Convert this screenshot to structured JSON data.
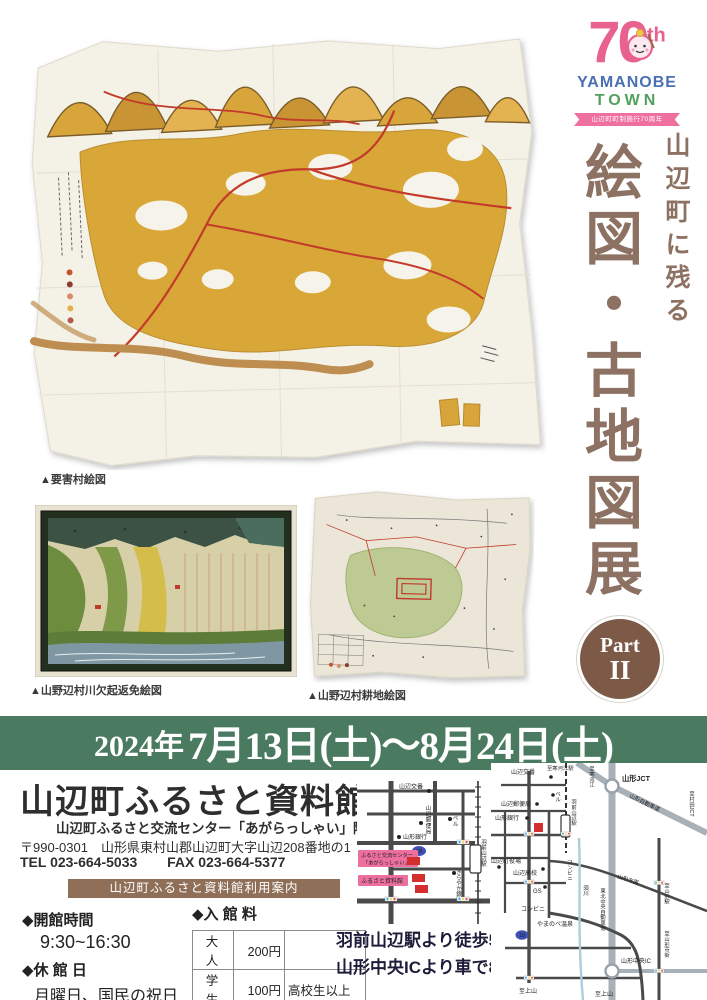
{
  "logo": {
    "number": "70",
    "suffix": "th",
    "name_top": "YAMANOBE",
    "name_bottom": "TOWN",
    "ribbon": "山辺町町制施行70周年"
  },
  "title": {
    "tagline": "山辺町に残る",
    "main": "絵図・古地図展",
    "part_label": "Part",
    "part_number": "II"
  },
  "captions": {
    "map1": "▲要害村絵図",
    "map2": "▲山野辺村川欠起返免絵図",
    "map3": "▲山野辺村耕地絵図"
  },
  "date_banner": {
    "year": "2024年",
    "range": "7月13日(土)～8月24日(土)"
  },
  "venue": {
    "name": "山辺町ふるさと資料館",
    "subtitle": "山辺町ふるさと交流センター「あがらっしゃい」隣接",
    "postal_address": "〒990-0301　山形県東村山郡山辺町大字山辺208番地の1",
    "tel": "TEL 023-664-5033",
    "fax": "FAX 023-664-5377",
    "info_bar": "山辺町ふるさと資料館利用案内"
  },
  "hours": {
    "open_label": "◆開館時間",
    "open_time": "9:30~16:30",
    "closed_label": "◆休 館 日",
    "closed_days": "月曜日、国民の祝日"
  },
  "admission": {
    "label": "◆入 館 料",
    "rows": [
      {
        "type": "大 人",
        "fee": "200円",
        "note": ""
      },
      {
        "type": "学 生",
        "fee": "100円",
        "note": "高校生以上"
      },
      {
        "type": "小 人",
        "fee": "50円",
        "note": "小中児童生徒"
      }
    ]
  },
  "access": {
    "walk": "羽前山辺駅より徒歩5分",
    "car": "山形中央ICより車で8分"
  },
  "access_map": {
    "labels": {
      "police": "山辺交番",
      "post_office": "山辺郵便局",
      "bell": "ベル",
      "yamagata_bank": "山形銀行",
      "route_no": "18",
      "center_line1": "ふるさと交流センター",
      "center_line2": "「あがらっしゃい」",
      "museum": "ふるさと資料館",
      "kirayaka_bank": "きらやか銀行",
      "station": "羽前山辺駅"
    }
  },
  "area_map": {
    "labels": {
      "police": "山辺交番",
      "to_sagae_sta": "至寒河江駅",
      "jct": "山形JCT",
      "to_sagae": "至寒河江",
      "yamagata_expwy": "山形自動車道",
      "to_murata": "至村田JCT",
      "post_office": "山辺郵便局",
      "yamagata_bank": "山形銀行",
      "bell": "ベル",
      "station": "羽前山辺駅",
      "town_hall": "山辺町役場",
      "high_school": "山辺高校",
      "gas": "GS",
      "conv_a": "コンビニ",
      "conv_b": "コンビニ",
      "onsen": "やまのべ温泉",
      "route_no": "18",
      "river": "須川",
      "tohoku_expwy": "東北中央自動車道",
      "ic": "山形中央IC",
      "to_kaminoyama_a": "至上山",
      "to_kaminoyama_b": "至上山",
      "to_yamagata_dir": "山形方面",
      "to_yamagata_sta": "至山形駅",
      "to_yamagata_city": "至山形市街"
    }
  },
  "colors": {
    "banner_green": "#4a7b60",
    "title_brown": "#8d7263",
    "bar_brown": "#8f6f58",
    "logo_pink": "#e8618f",
    "logo_blue": "#4a6fb3",
    "logo_green": "#53a05e",
    "accent_red": "#d32f2f"
  }
}
